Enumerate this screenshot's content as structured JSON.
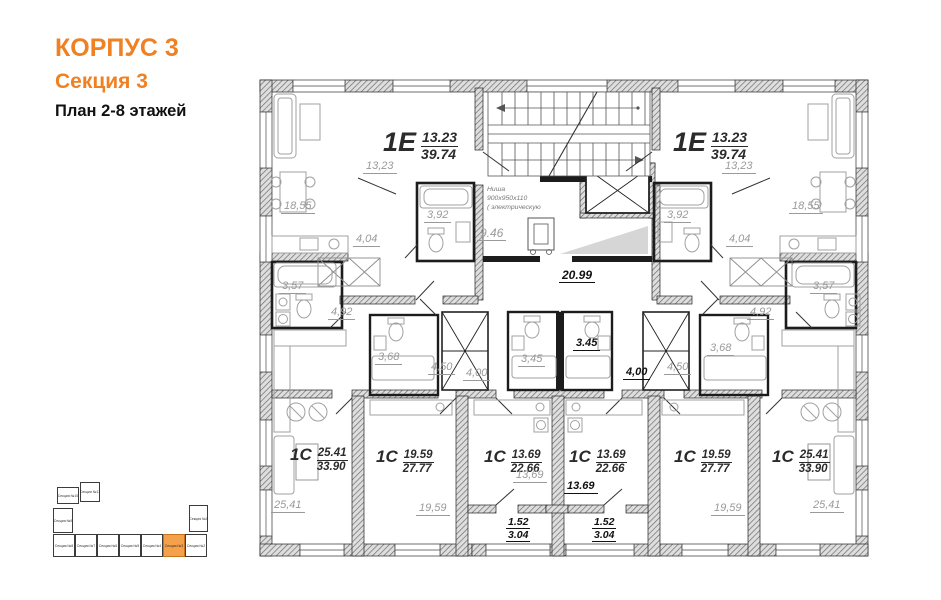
{
  "title": {
    "line1": "КОРПУС 3",
    "line2": "Секция 3",
    "line3": "План 2-8 этажей"
  },
  "colors": {
    "accent": "#F08122",
    "highlight_fill": "#F5A04A"
  },
  "apartments": {
    "e_left": {
      "type": "1Е",
      "num": "13.23",
      "den": "39.74"
    },
    "e_right": {
      "type": "1Е",
      "num": "13.23",
      "den": "39.74"
    },
    "c1": {
      "type": "1С",
      "num": "25.41",
      "den": "33.90"
    },
    "c2": {
      "type": "1С",
      "num": "19.59",
      "den": "27.77"
    },
    "c3": {
      "type": "1С",
      "num": "13.69",
      "den": "22.66"
    },
    "c4": {
      "type": "1С",
      "num": "13.69",
      "den": "22.66"
    },
    "c5": {
      "type": "1С",
      "num": "19.59",
      "den": "27.77"
    },
    "c6": {
      "type": "1С",
      "num": "25.41",
      "den": "33.90"
    }
  },
  "areas": {
    "dim_e_left": "13,23",
    "dim_e_right": "13,23",
    "living_left": "18,55",
    "living_right": "18,55",
    "bath_e_left": "3,92",
    "bath_e_right": "3,92",
    "hall_e_left": "4,04",
    "hall_e_right": "4,04",
    "lobby": "9.46",
    "corridor": "20.99",
    "bath_c1": "3,57",
    "bath_c6": "3,57",
    "hall_c1": "4,92",
    "hall_c6": "4,92",
    "bath_c2": "3,68",
    "bath_c5": "3,68",
    "shaft_left_a": "4,50",
    "shaft_left_b": "4,00",
    "shaft_right_a": "4,00",
    "shaft_right_b": "4,50",
    "bath_c3": "3,45",
    "bath_c4": "3.45",
    "room_c1": "25,41",
    "room_c2": "19,59",
    "room_c3": "13,69",
    "room_c4": "13.69",
    "room_c5": "19,59",
    "room_c6": "25,41"
  },
  "balconies": {
    "left": {
      "num": "1.52",
      "den": "3.04"
    },
    "right": {
      "num": "1.52",
      "den": "3.04"
    }
  },
  "note": {
    "line1": "Ниша",
    "line2": "900х950х110",
    "line3": "( электрическую"
  },
  "key_plan": {
    "sections": [
      {
        "label": "Секция №10"
      },
      {
        "label": "Секция №11"
      },
      {
        "label": "Секция №9"
      },
      {
        "label": "Секция №8"
      },
      {
        "label": "Секция №7"
      },
      {
        "label": "Секция №6"
      },
      {
        "label": "Секция №5"
      },
      {
        "label": "Секция №4"
      },
      {
        "label": "Секция №3",
        "highlighted": true
      },
      {
        "label": "Секция №2"
      },
      {
        "label": "Секция №1"
      }
    ]
  }
}
